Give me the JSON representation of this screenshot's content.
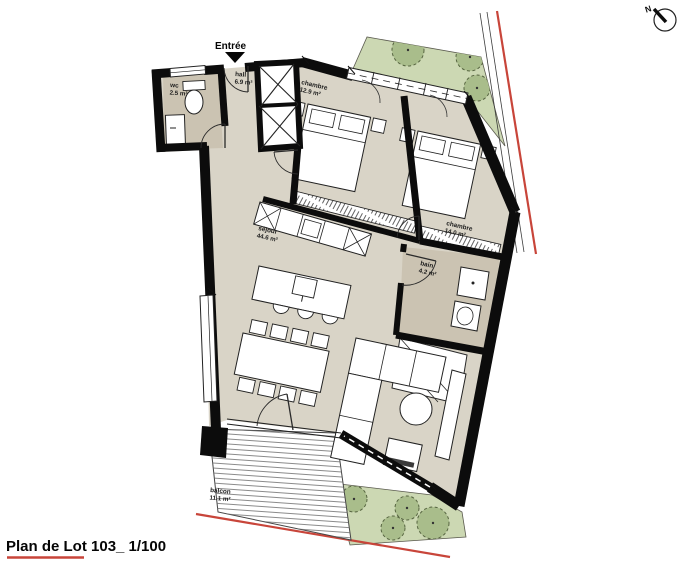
{
  "footer": {
    "title": "Plan de Lot 103_ 1/100"
  },
  "entrance": {
    "label": "Entrée"
  },
  "north": {
    "label": "N"
  },
  "rooms": {
    "wc": {
      "name": "wc",
      "area": "2.5 m²"
    },
    "hall": {
      "name": "hall",
      "area": "6.9 m²"
    },
    "chambre1": {
      "name": "chambre",
      "area": "12.9 m²"
    },
    "chambre2": {
      "name": "chambre",
      "area": "14.0 m²"
    },
    "bain": {
      "name": "bain",
      "area": "4.2 m²"
    },
    "sejour": {
      "name": "séjour",
      "area": "44.6 m²"
    },
    "balcon": {
      "name": "balcon",
      "area": "11.1 m²"
    }
  },
  "colors": {
    "wall": "#0c0c0c",
    "floor": "#d9d4c7",
    "wet_floor": "#cbc3b2",
    "furniture": "#ffffff",
    "garden": "#ccd8b3",
    "bush": "#a9bd8b",
    "boundary_red": "#c8453a"
  }
}
